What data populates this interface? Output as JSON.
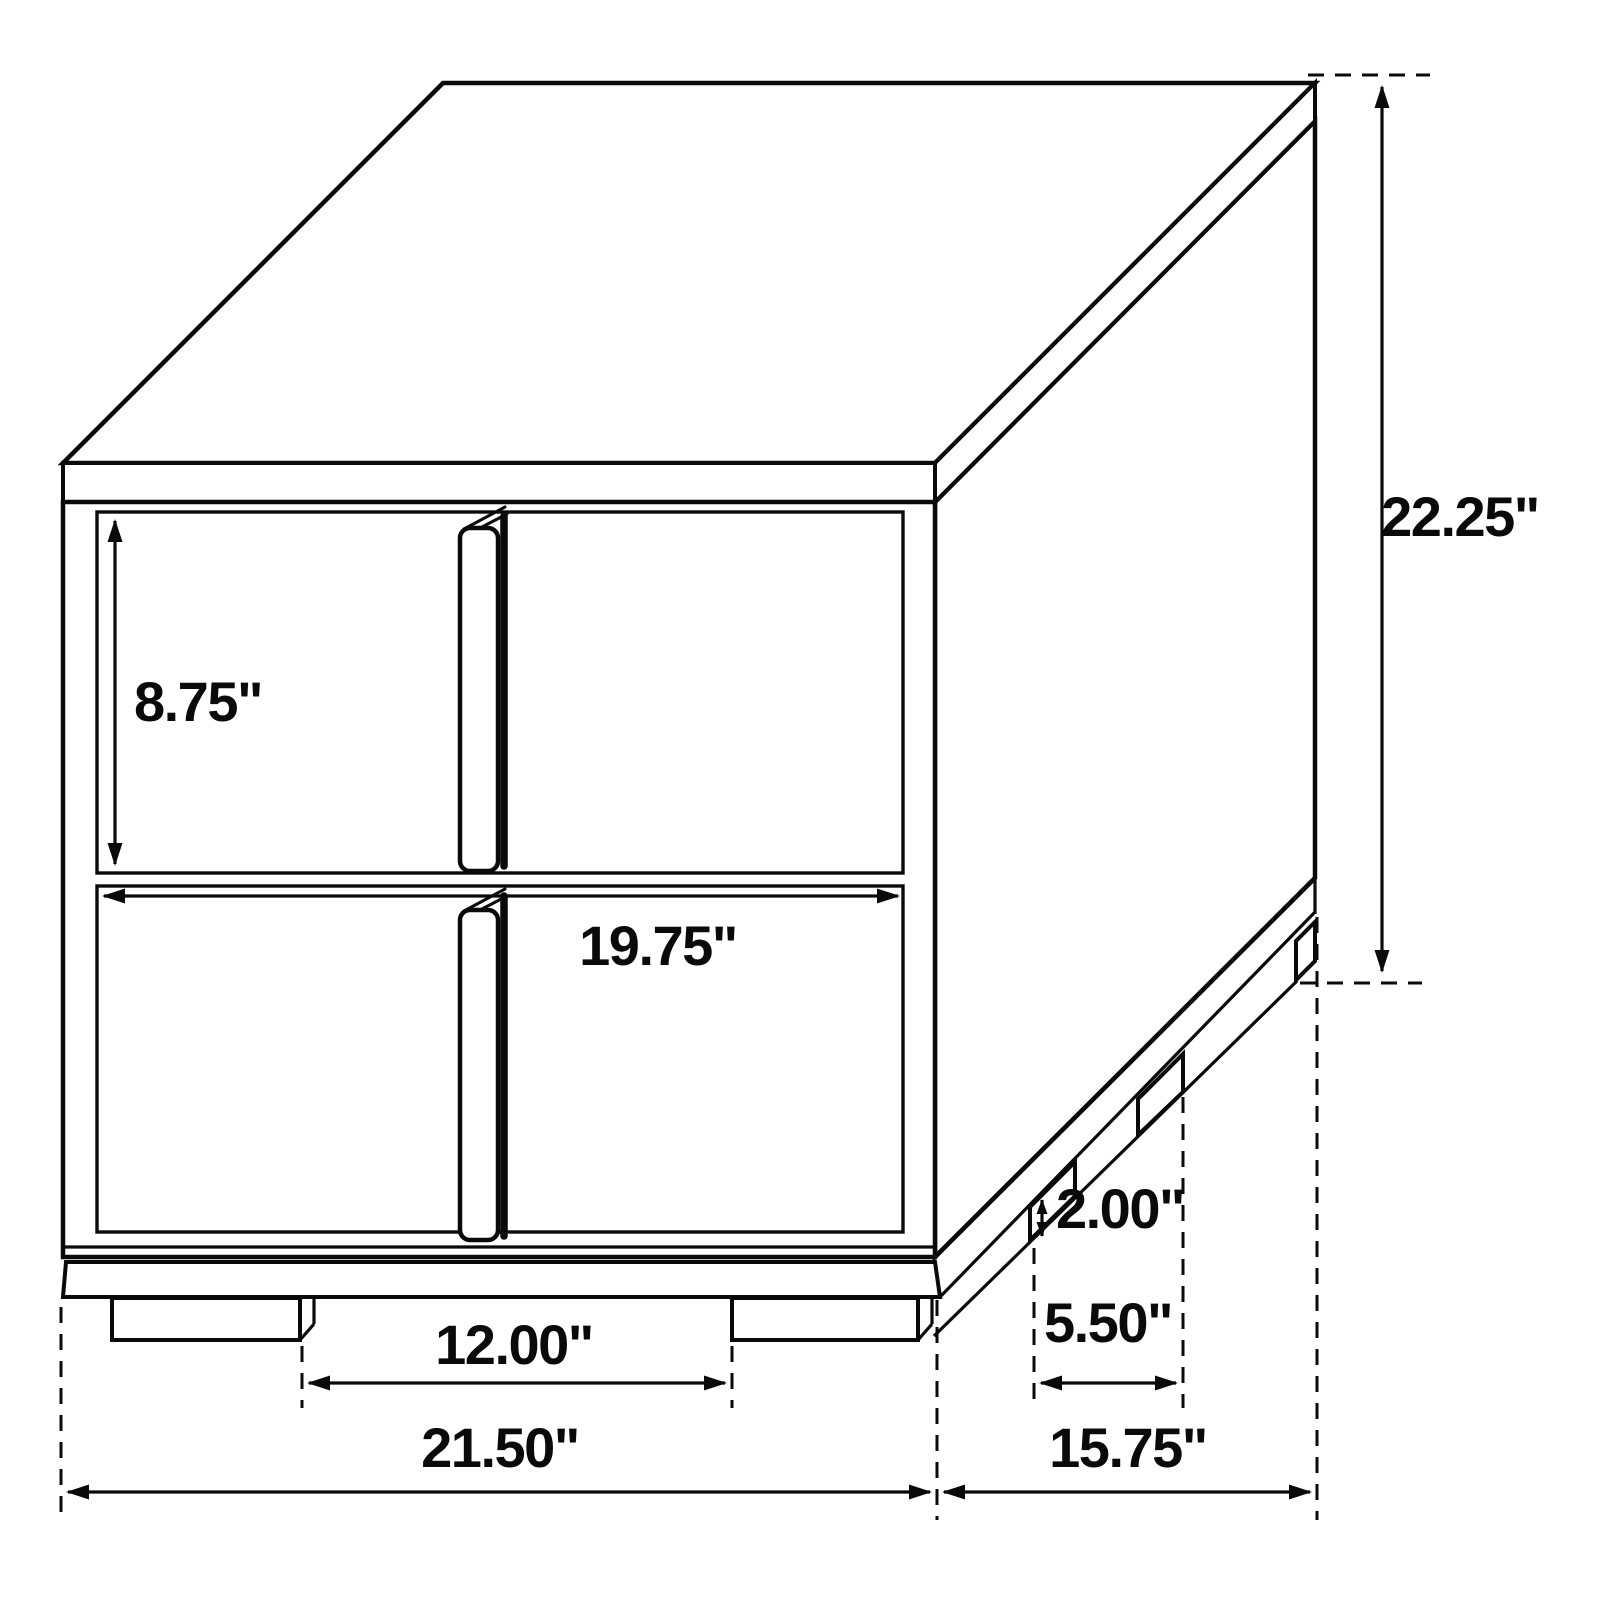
{
  "figure": {
    "kind": "furniture-dimension-line-drawing",
    "subject": "two-drawer nightstand, oblique 3D view",
    "background_color": "#ffffff",
    "line_color": "#0a0a0a"
  },
  "dimensions": {
    "drawer_front_height": "8.75\"",
    "drawer_front_width": "19.75\"",
    "overall_height": "22.25\"",
    "leg_height": "2.00\"",
    "side_leg_spacing": "5.50\"",
    "front_leg_spacing": "12.00\"",
    "overall_width": "21.50\"",
    "overall_depth": "15.75\""
  }
}
